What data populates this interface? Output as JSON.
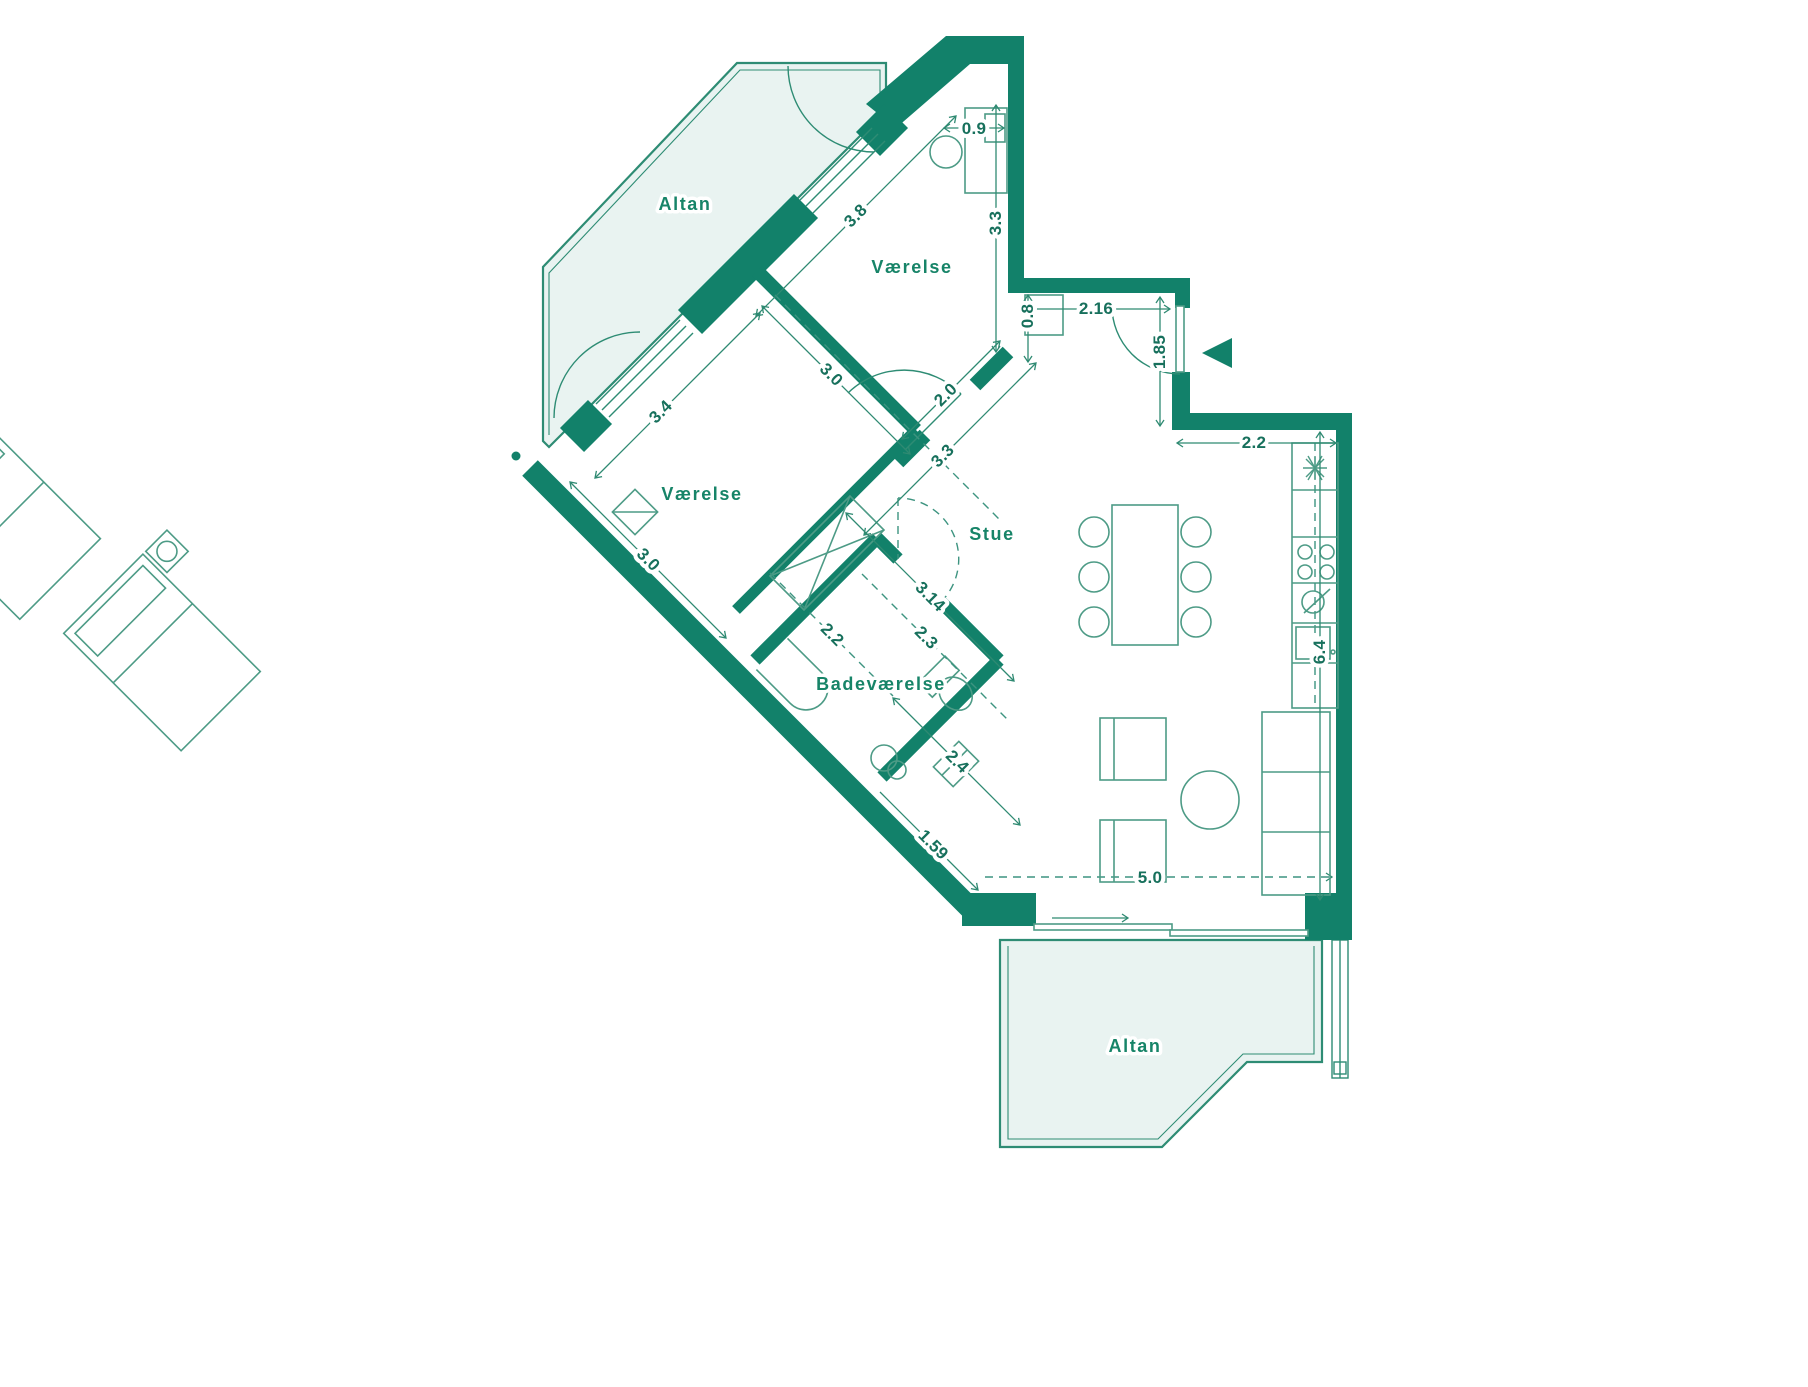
{
  "plan": {
    "rooms": {
      "balcony_top": {
        "label": "Altan"
      },
      "bedroom_top": {
        "label": "Værelse"
      },
      "bedroom_left": {
        "label": "Værelse"
      },
      "living": {
        "label": "Stue"
      },
      "bathroom": {
        "label": "Badeværelse"
      },
      "balcony_bottom": {
        "label": "Altan"
      }
    },
    "dimensions": {
      "d09": "0.9",
      "d38": "3.8",
      "d33a": "3.3",
      "d216": "2.16",
      "d08": "0.8",
      "d185": "1.85",
      "d22k": "2.2",
      "d34": "3.4",
      "d30a": "3.0",
      "d20": "2.0",
      "d33b": "3.3",
      "d30b": "3.0",
      "d314": "3.14",
      "d22b": "2.2",
      "d23": "2.3",
      "d24": "2.4",
      "d64": "6.4",
      "d159": "1.59",
      "d50": "5.0"
    },
    "colors": {
      "wall_green": "#12816A",
      "balcony_fill": "#E9F3F1",
      "line_green": "#2E8C74",
      "text_green": "#17705C"
    }
  }
}
